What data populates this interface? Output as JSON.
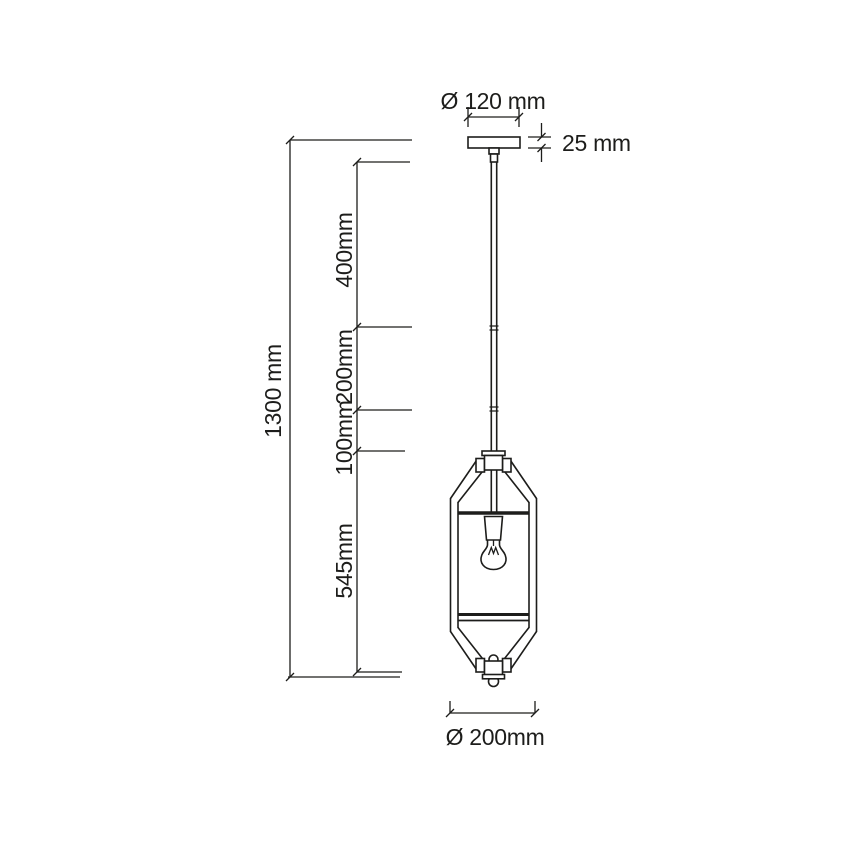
{
  "title": "Pendant lamp dimension drawing",
  "colors": {
    "line": "#1d1d1b",
    "background": "#ffffff"
  },
  "labels": {
    "canopy_diameter": "Ø 120 mm",
    "canopy_height": "25 mm",
    "total_height": "1300 mm",
    "rod_section_top": "400mm",
    "rod_section_middle": "200mm",
    "rod_section_bottom": "100mm",
    "lantern_height": "545mm",
    "lantern_diameter": "Ø 200mm"
  },
  "dimensions_mm": {
    "canopy_diameter": 120,
    "canopy_height": 25,
    "total_height": 1300,
    "rod_sections": [
      400,
      200,
      100
    ],
    "lantern_height": 545,
    "lantern_diameter": 200
  }
}
